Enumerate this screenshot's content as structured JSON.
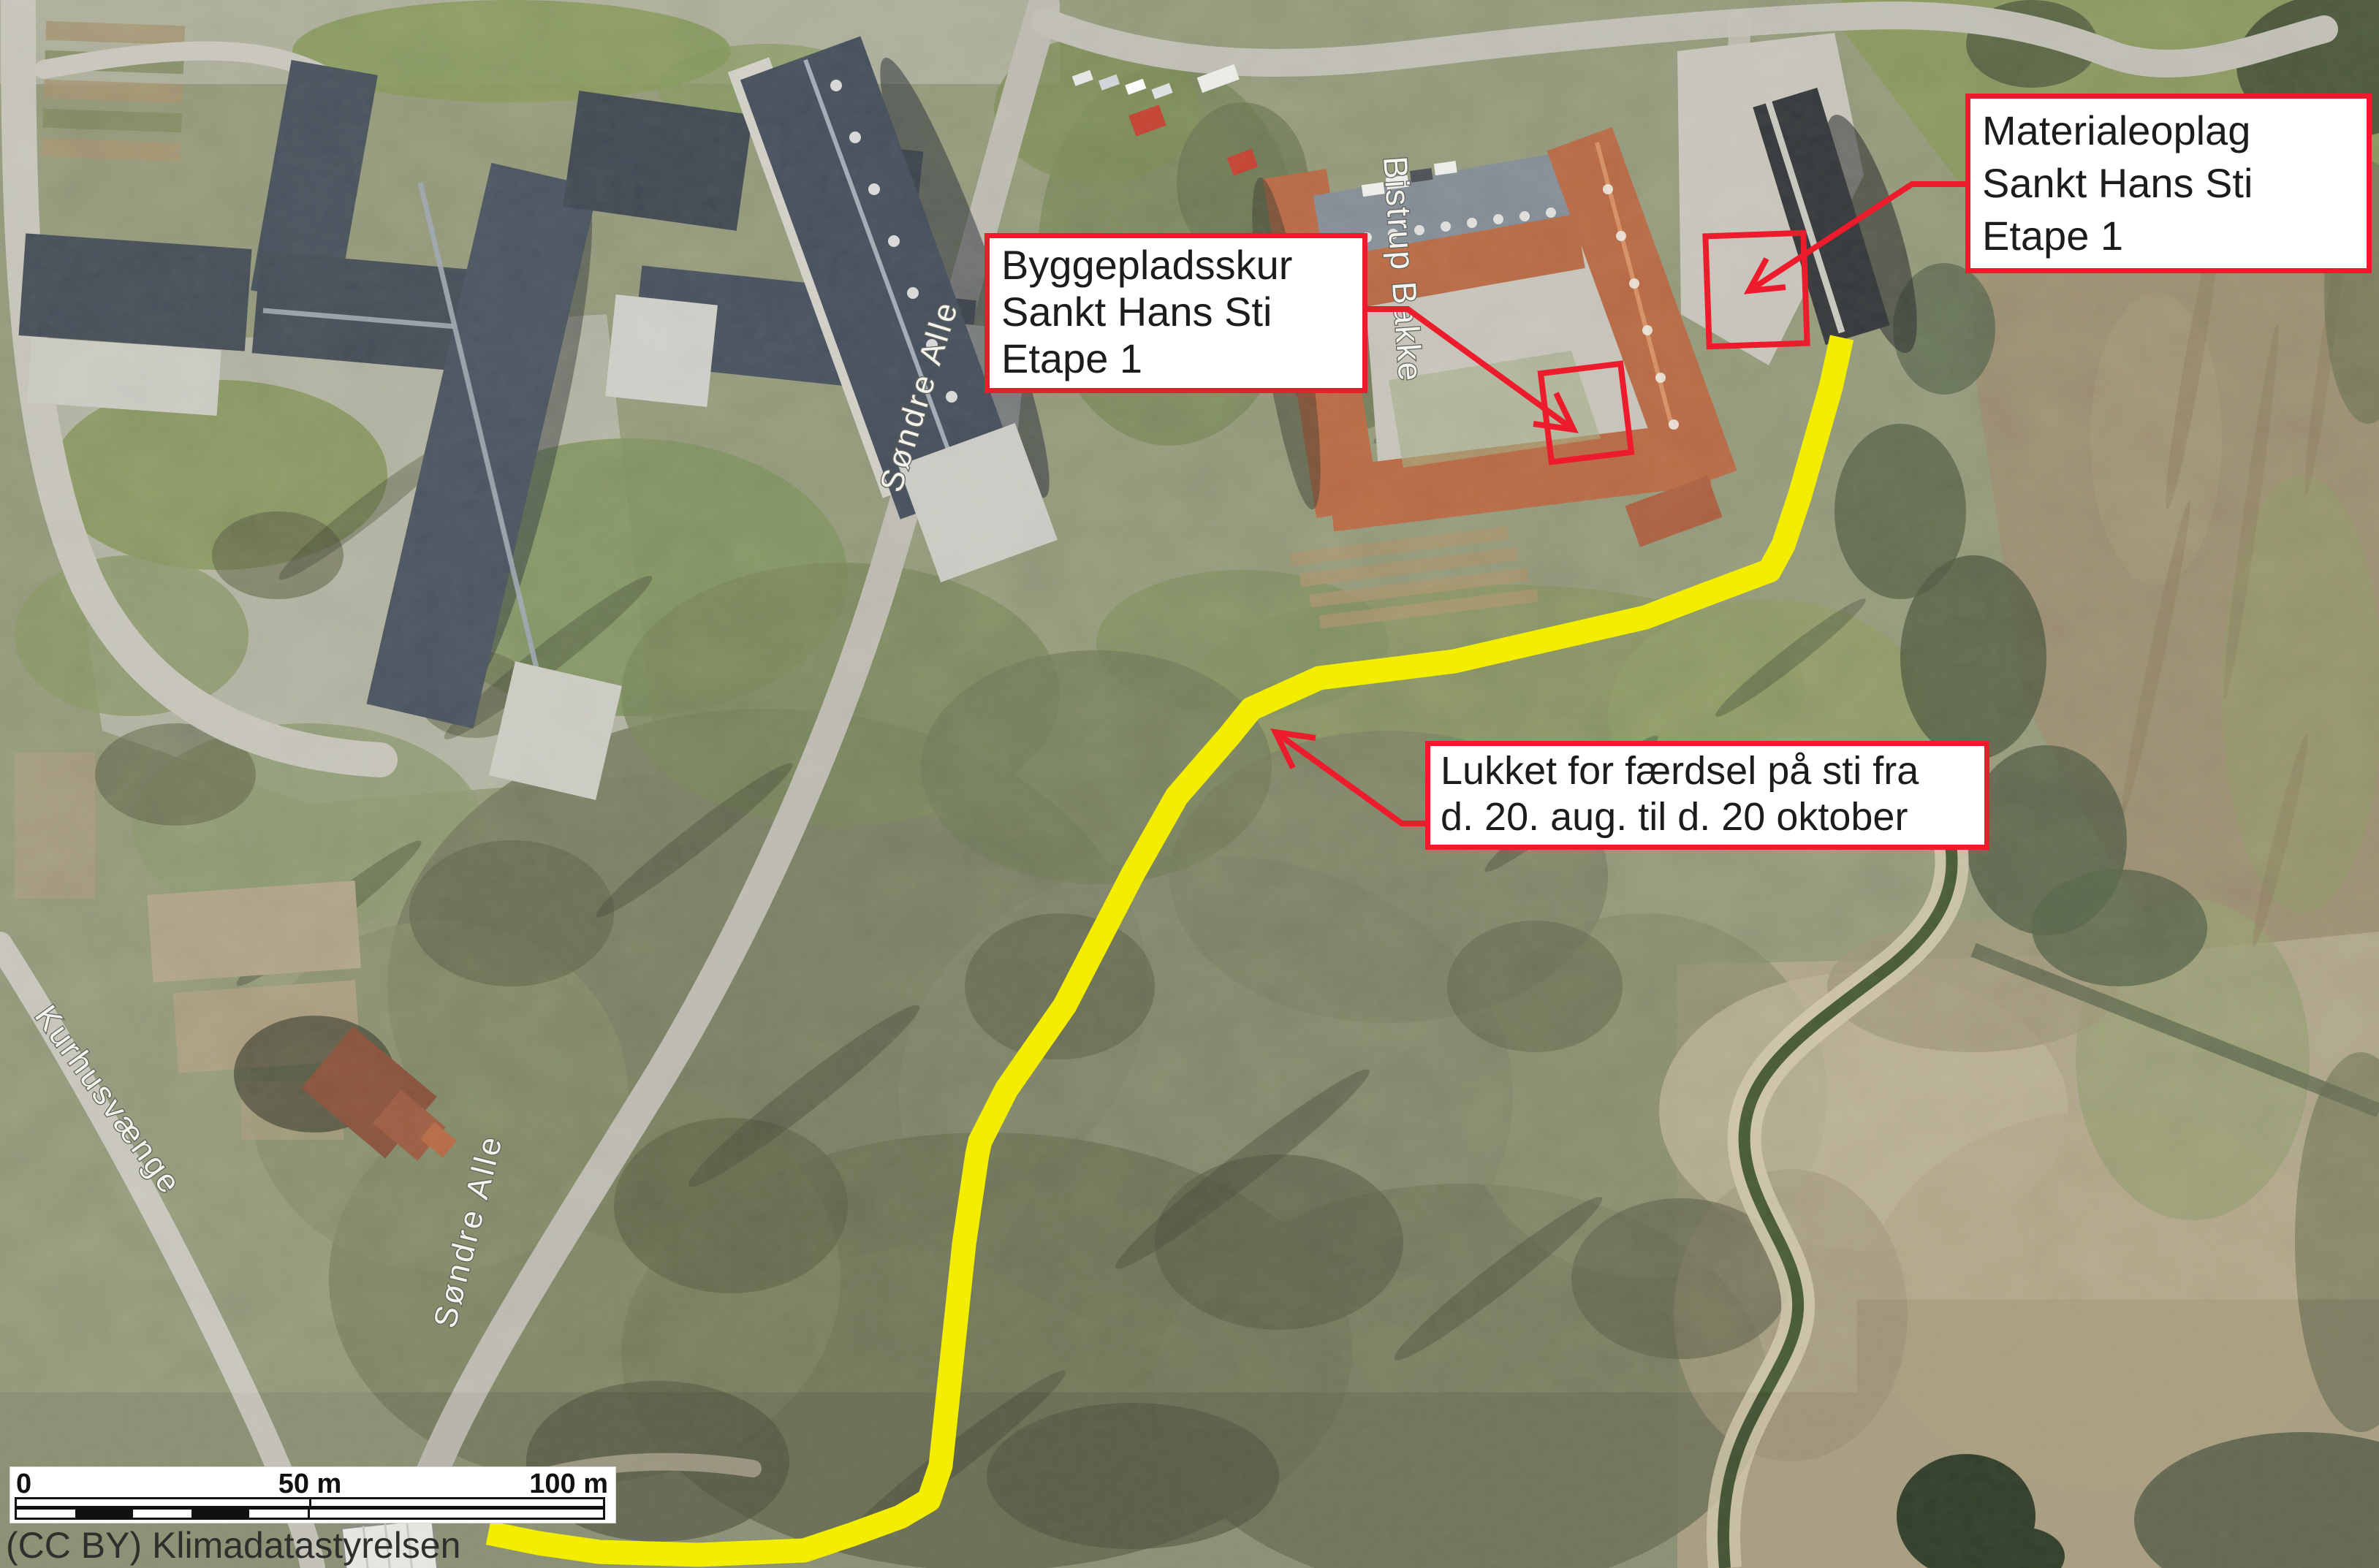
{
  "map": {
    "type": "annotated-aerial-orthophoto",
    "annotation_boxes": [
      {
        "id": "byggepladsskur",
        "lines": [
          "Byggepladsskur",
          "Sankt Hans Sti",
          "Etape 1"
        ]
      },
      {
        "id": "materialeoplag",
        "lines": [
          "Materialeoplag",
          "Sankt Hans Sti",
          "Etape 1"
        ]
      },
      {
        "id": "sti-lukket",
        "lines": [
          "Lukket for færdsel på sti fra",
          "d. 20. aug. til d. 20 oktober"
        ]
      }
    ],
    "street_labels": [
      {
        "text": "Bistrup Bakke"
      },
      {
        "text": "Søndre Alle"
      },
      {
        "text": "Søndre Alle"
      },
      {
        "text": "Kurhusvænge"
      }
    ],
    "scale_bar": {
      "tick_0": "0",
      "tick_50": "50 m",
      "tick_100": "100 m"
    },
    "attribution": "(CC BY) Klimadatastyrelsen",
    "markers": {
      "leader_arrow": "red open-head arrow",
      "work_area_rectangles": 2,
      "closed_path_line": "thick yellow polyline marking closed trail"
    },
    "colors": {
      "annotation_red": "#ec1c2c",
      "path_yellow": "#f3ee00",
      "box_background": "#ffffff",
      "label_text": "#1c1c1c"
    }
  }
}
